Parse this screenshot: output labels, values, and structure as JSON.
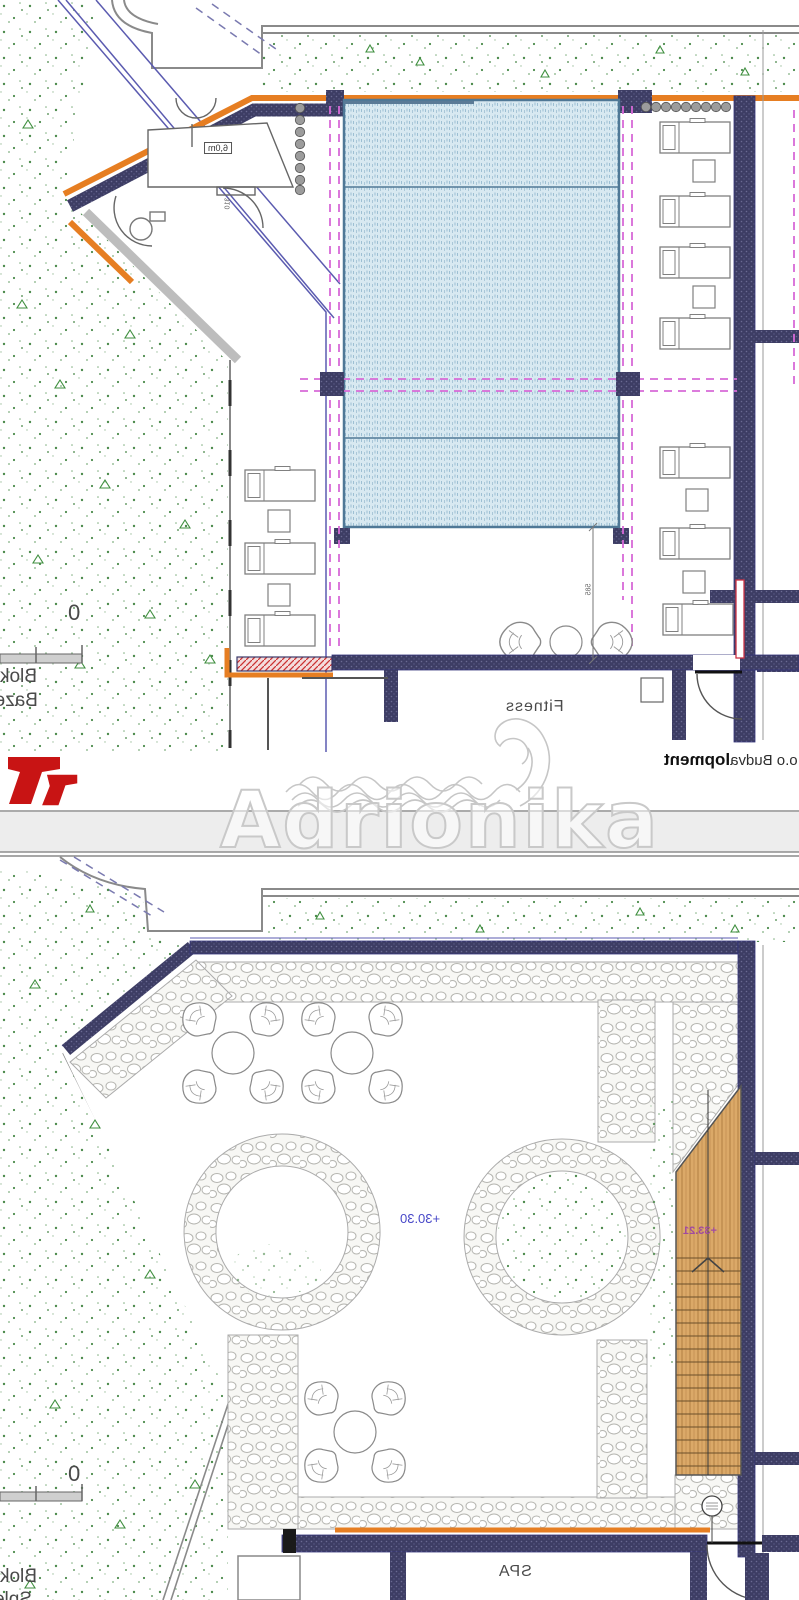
{
  "document": {
    "type": "architectural site plan, horizontally mirrored scan",
    "sheets": [
      "pool and fitness terrace level",
      "spa terrace level"
    ]
  },
  "labels": {
    "dim_6m": "6,0m",
    "dim_310": "310",
    "dim_585": "585",
    "fitness": "Fitness",
    "spa": "SPA",
    "blok_top": "Blok",
    "bazen_top": "Bazen",
    "blok_bottom": "Blok",
    "sple_bottom": "Sple",
    "level_plaza": "+30.30",
    "level_deck": "+33.21",
    "scale_zero_top": "0",
    "scale_zero_bottom": "0"
  },
  "credit": {
    "bold": "lopment",
    "rest": " D.o.o Budva"
  },
  "watermark": "Adrionika",
  "colors": {
    "accent_orange": "#e67e22",
    "wall_navy": "#3d3d66",
    "pool_blue": "#d8e9f1",
    "pool_border": "#4f7896",
    "magenta_dash": "#d76ad7",
    "red_logo": "#c81414",
    "red_wall_hatch": "#cc3333",
    "grass_green": "#4c8b4c",
    "wood_tan": "#dba968",
    "pebble_gray": "#b5b5b0",
    "level_blue": "#4848c8",
    "level_purple": "#a04aa0"
  }
}
